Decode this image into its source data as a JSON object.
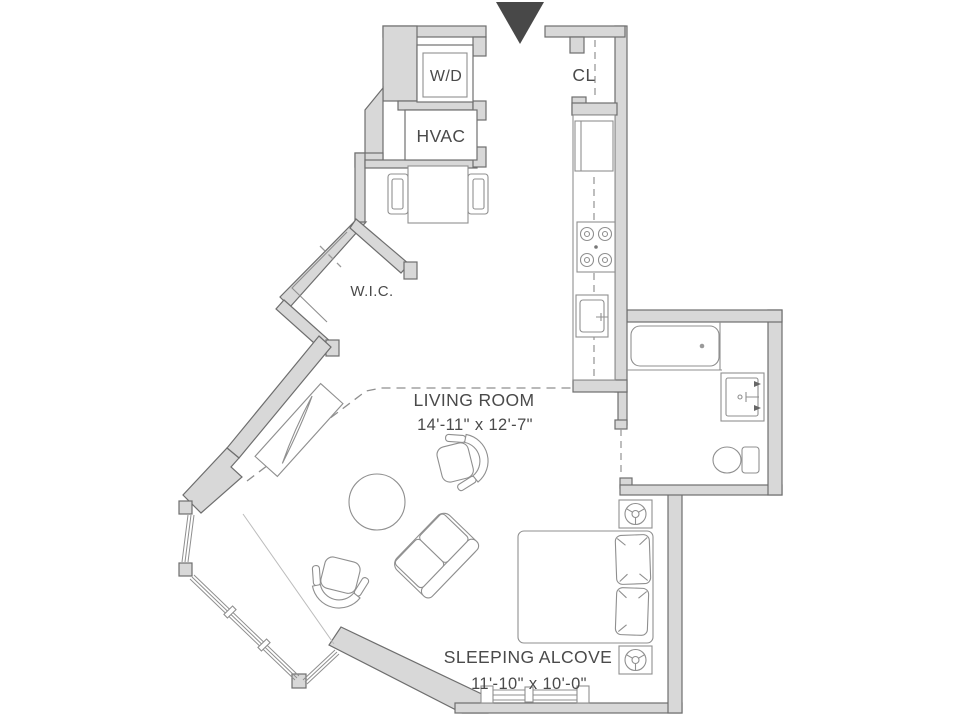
{
  "plan_title": "Studio apartment floor plan",
  "labels": {
    "washer_dryer": "W/D",
    "hvac": "HVAC",
    "closet": "CL",
    "walk_in_closet": "W.I.C.",
    "living_room": {
      "name": "LIVING ROOM",
      "dimensions": "14'-11\" x 12'-7\""
    },
    "sleeping_alcove": {
      "name": "SLEEPING ALCOVE",
      "dimensions": "11'-10\" x 10'-0\""
    }
  },
  "colors": {
    "wall_fill": "#d8d8d8",
    "wall_stroke": "#6e6e6e",
    "furniture_stroke": "#8f8f8f",
    "text": "#4a4a4a",
    "entry_arrow": "#484848",
    "background": "#ffffff"
  },
  "fixtures": [
    "entry-arrow-icon",
    "washer-dryer",
    "hvac-unit",
    "dining-table",
    "dining-chairs",
    "closet-rod",
    "refrigerator",
    "stove-burners",
    "kitchen-sink",
    "bathtub",
    "vanity-sink",
    "toilet",
    "walk-in-closet-shelves",
    "console-desk",
    "round-table",
    "tub-chair",
    "loveseat-sofa",
    "bed",
    "pillows",
    "nightstand-lamps",
    "bay-windows",
    "alcove-window"
  ]
}
